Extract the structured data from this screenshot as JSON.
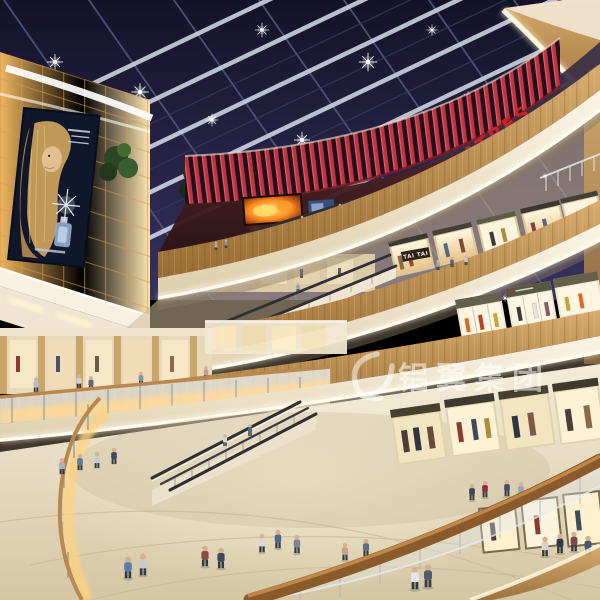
{
  "scene": {
    "type": "architectural rendering",
    "description": "Multi-level shopping mall atrium with glazed skylight ceiling, curved balconies, escalators, glowing advertisement wall, storefronts and shoppers"
  },
  "signs": {
    "theatres": "THEATRES",
    "tai_tai": "TAI TAI"
  },
  "watermark": {
    "text": "铝翼集团"
  },
  "colors": {
    "skylight": "#17142b",
    "marquee_red": "#c23340",
    "theatres_red": "#c8232b",
    "wood": "#c29255",
    "cream_fascia": "#f2ead8",
    "light_wall": "#ffd998",
    "led_fire_orange": "#ff8a1f",
    "floor": "#e8dec6"
  }
}
